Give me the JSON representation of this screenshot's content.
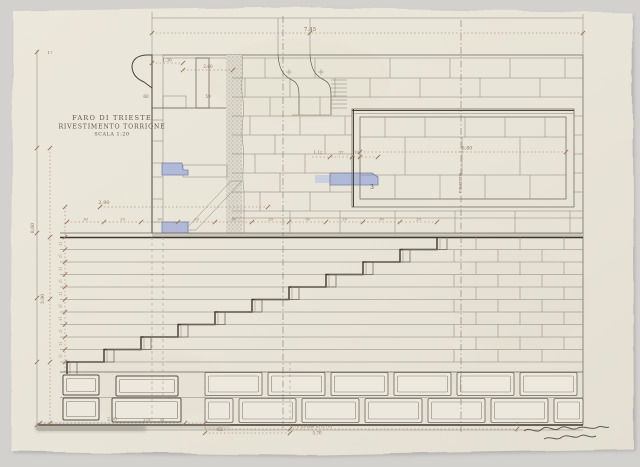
{
  "title_block": {
    "line1": "FARO DI TRIESTE",
    "line2": "RIVESTIMENTO TORRIONE",
    "line3": "SCALA 1:20"
  },
  "colors": {
    "background": "#d3d1cd",
    "paper": "#eae5d9",
    "line_ink": "#4a443b",
    "line_pencil": "#6d675c",
    "dimension_ink": "#8c7258",
    "blue_wash": "#b0bad8",
    "stipple_gray": "#97938a"
  },
  "annotations": [
    {
      "text": "7.45",
      "x": 310,
      "y": 31,
      "size": 5.5
    },
    {
      "text": "17",
      "x": 50,
      "y": 54,
      "size": 4
    },
    {
      "text": "1.30",
      "x": 167,
      "y": 61.5,
      "size": 4.2
    },
    {
      "text": "2.60",
      "x": 208,
      "y": 68,
      "size": 4.2
    },
    {
      "text": "60",
      "x": 146,
      "y": 98,
      "size": 4.2
    },
    {
      "text": "59",
      "x": 208,
      "y": 98,
      "size": 4.2
    },
    {
      "text": "2.90",
      "x": 104,
      "y": 204,
      "size": 5
    },
    {
      "text": "8.60",
      "x": 34,
      "y": 228,
      "size": 4.6,
      "rot": -90
    },
    {
      "text": "3.90",
      "x": 44,
      "y": 299,
      "size": 4.6,
      "rot": -90
    },
    {
      "text": "1.12",
      "x": 318,
      "y": 153.5,
      "size": 4
    },
    {
      "text": "37",
      "x": 341,
      "y": 153.5,
      "size": 4
    },
    {
      "text": "10",
      "x": 356.5,
      "y": 153.5,
      "size": 4
    },
    {
      "text": "6.80",
      "x": 467,
      "y": 149.5,
      "size": 4.8
    },
    {
      "text": "MEZZERIA",
      "x": 459,
      "y": 183,
      "size": 3.6,
      "rot": 90
    },
    {
      "text": "3",
      "x": 372,
      "y": 189,
      "size": 6,
      "color": "#5a544a",
      "name": "stone-number-label"
    },
    {
      "text": "2.50",
      "x": 112,
      "y": 420.5,
      "size": 4.4
    },
    {
      "text": "1.01",
      "x": 147,
      "y": 421,
      "size": 3.6
    },
    {
      "text": "35",
      "x": 162,
      "y": 421,
      "size": 3.6
    },
    {
      "text": "62",
      "x": 220,
      "y": 431,
      "size": 4.6
    },
    {
      "text": "8.70 (totale m 8.70)",
      "x": 311,
      "y": 427.5,
      "size": 4.2
    },
    {
      "text": "5.70",
      "x": 317,
      "y": 434.5,
      "size": 4.2
    },
    {
      "text": "30",
      "x": 85.5,
      "y": 220.5,
      "size": 3.6
    },
    {
      "text": "29",
      "x": 122.5,
      "y": 220.5,
      "size": 3.6
    },
    {
      "text": "30",
      "x": 159.5,
      "y": 220.5,
      "size": 3.6
    },
    {
      "text": "29",
      "x": 196.5,
      "y": 220.5,
      "size": 3.6
    },
    {
      "text": "30",
      "x": 233.5,
      "y": 220.5,
      "size": 3.6
    },
    {
      "text": "29",
      "x": 270.5,
      "y": 220.5,
      "size": 3.6
    },
    {
      "text": "30",
      "x": 307.5,
      "y": 220.5,
      "size": 3.6
    },
    {
      "text": "29",
      "x": 344.5,
      "y": 220.5,
      "size": 3.6
    },
    {
      "text": "30",
      "x": 381.5,
      "y": 220.5,
      "size": 3.6
    },
    {
      "text": "29",
      "x": 418.5,
      "y": 220.5,
      "size": 3.6
    },
    {
      "text": "21",
      "x": 61.5,
      "y": 243.6,
      "size": 3.2,
      "rot": -90
    },
    {
      "text": "21",
      "x": 61.5,
      "y": 256,
      "size": 3.2,
      "rot": -90
    },
    {
      "text": "21",
      "x": 61.5,
      "y": 268.6,
      "size": 3.2,
      "rot": -90
    },
    {
      "text": "21",
      "x": 61.5,
      "y": 281,
      "size": 3.2,
      "rot": -90
    },
    {
      "text": "21",
      "x": 61.5,
      "y": 293.6,
      "size": 3.2,
      "rot": -90
    },
    {
      "text": "21",
      "x": 61.5,
      "y": 306,
      "size": 3.2,
      "rot": -90
    },
    {
      "text": "21",
      "x": 61.5,
      "y": 318.6,
      "size": 3.2,
      "rot": -90
    },
    {
      "text": "21",
      "x": 61.5,
      "y": 331,
      "size": 3.2,
      "rot": -90
    },
    {
      "text": "21",
      "x": 61.5,
      "y": 343.6,
      "size": 3.2,
      "rot": -90
    },
    {
      "text": "21",
      "x": 61.5,
      "y": 356,
      "size": 3.2,
      "rot": -90
    }
  ]
}
